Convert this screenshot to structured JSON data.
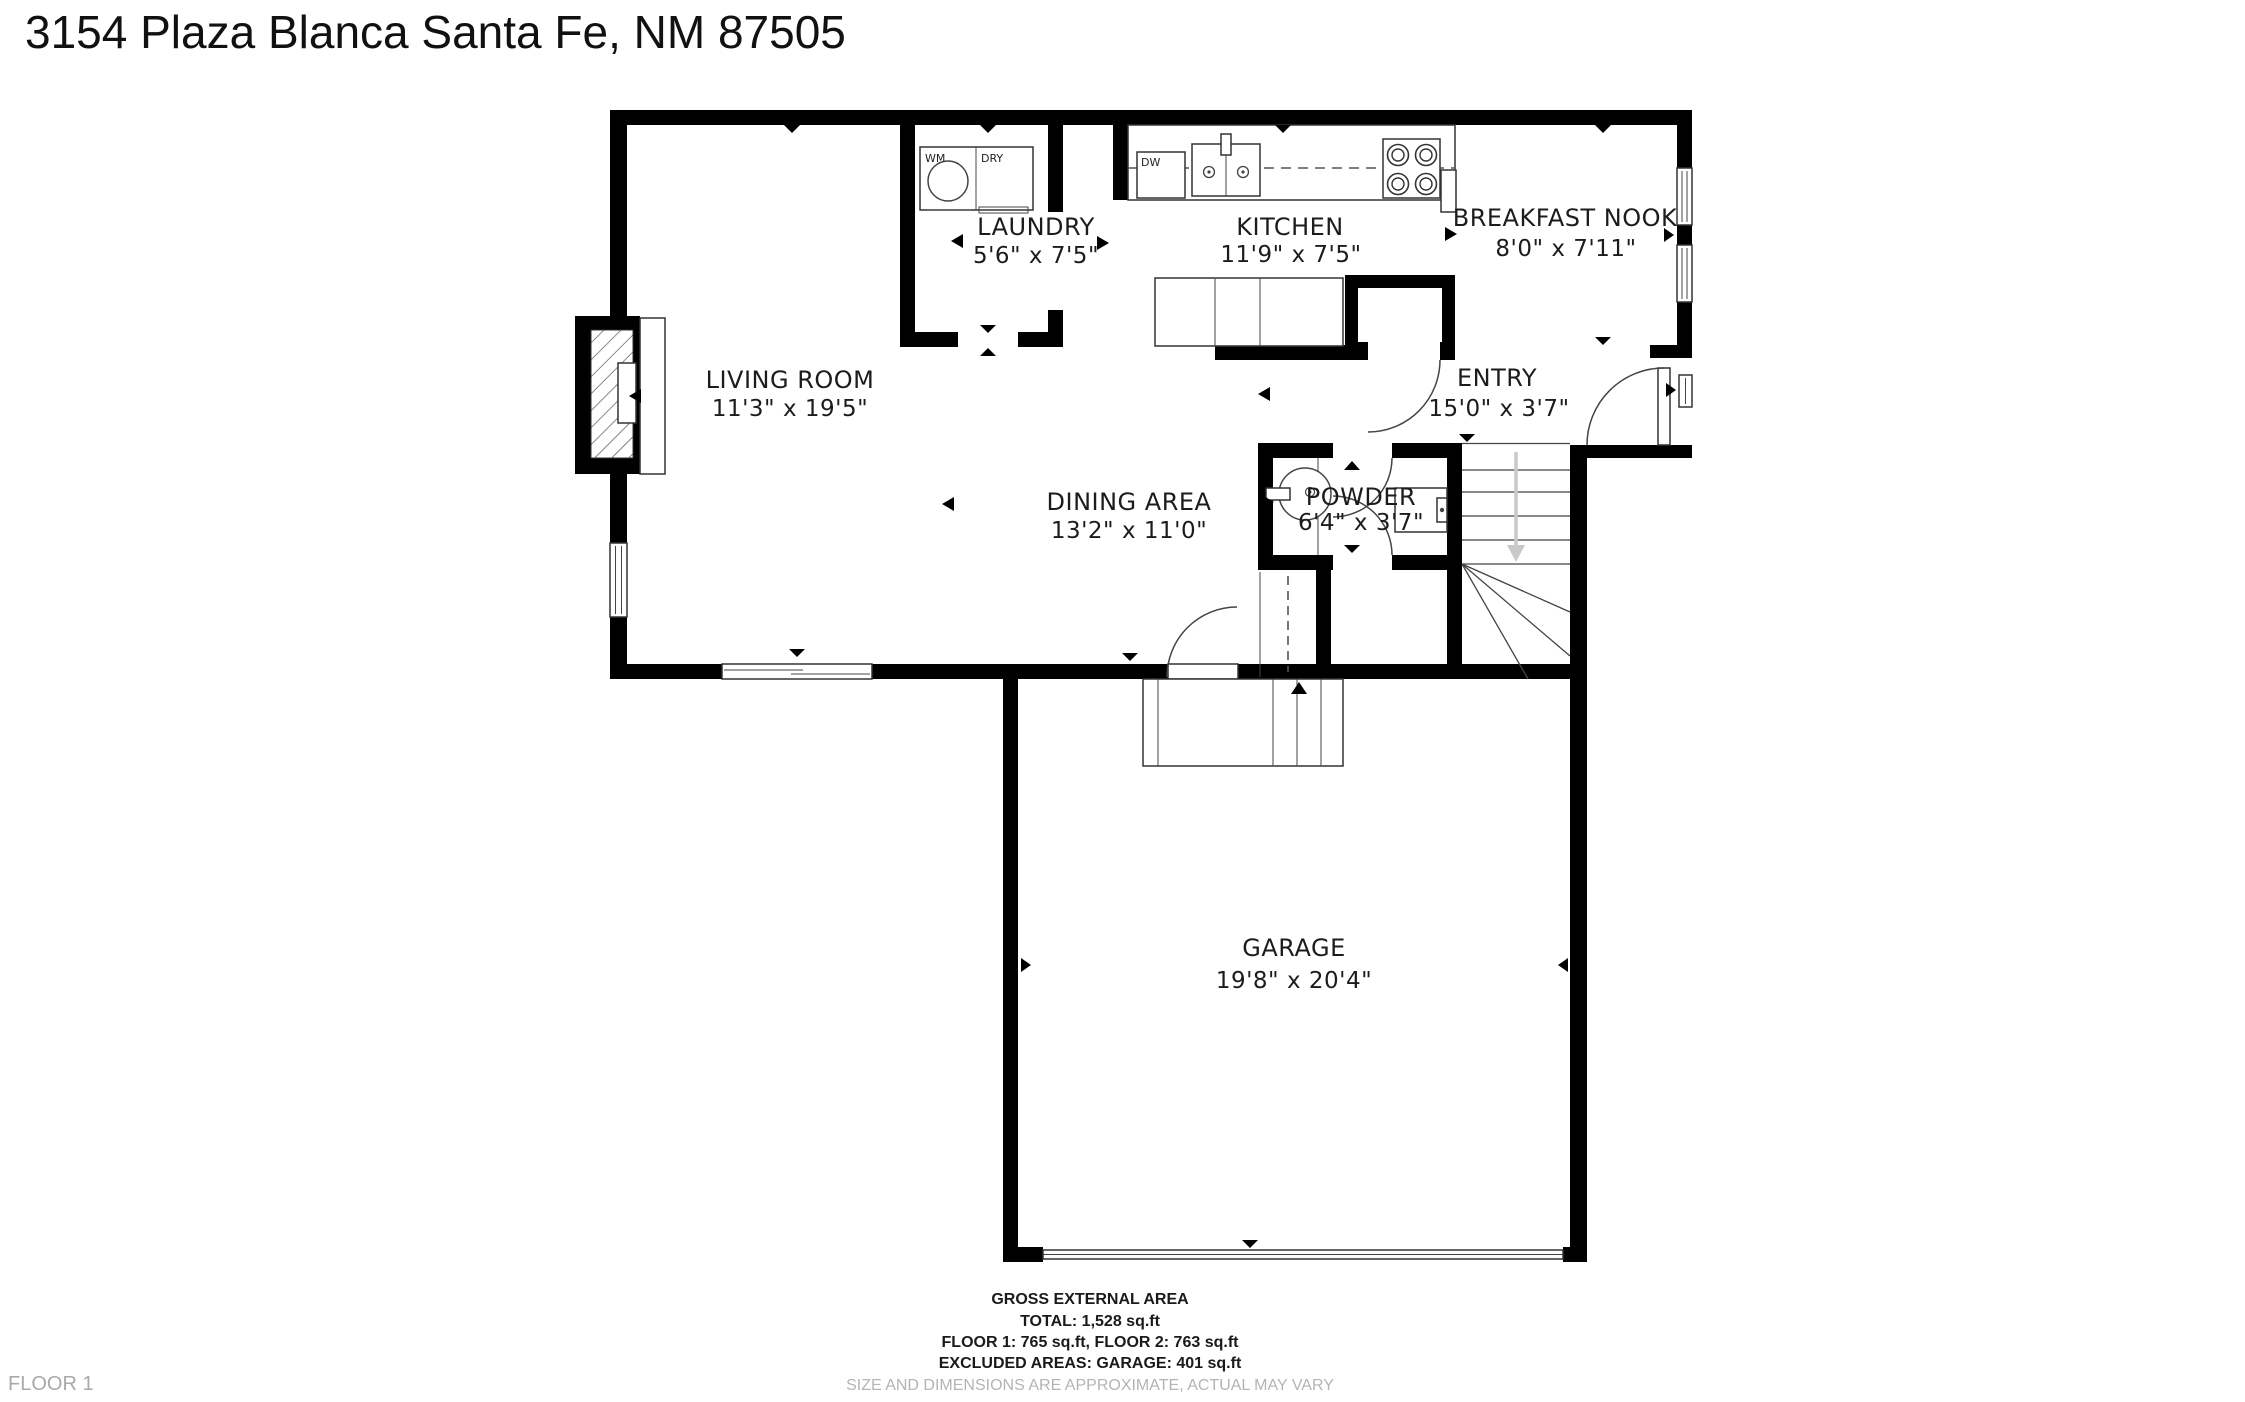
{
  "page": {
    "title": "3154 Plaza Blanca Santa Fe, NM 87505",
    "floor_label": "FLOOR 1"
  },
  "rooms": {
    "living_room": {
      "name": "LIVING ROOM",
      "dims": "11'3\" x 19'5\""
    },
    "laundry": {
      "name": "LAUNDRY",
      "dims": "5'6\" x 7'5\""
    },
    "kitchen": {
      "name": "KITCHEN",
      "dims": "11'9\" x 7'5\""
    },
    "breakfast_nook": {
      "name": "BREAKFAST NOOK",
      "dims": "8'0\" x 7'11\""
    },
    "entry": {
      "name": "ENTRY",
      "dims": "15'0\" x 3'7\""
    },
    "dining_area": {
      "name": "DINING AREA",
      "dims": "13'2\" x 11'0\""
    },
    "powder": {
      "name": "POWDER",
      "dims": "6'4\" x 3'7\""
    },
    "garage": {
      "name": "GARAGE",
      "dims": "19'8\" x 20'4\""
    }
  },
  "appliances": {
    "washer": "WM",
    "dryer": "DRY",
    "dishwasher": "DW"
  },
  "area_summary": {
    "heading": "GROSS EXTERNAL AREA",
    "total": "TOTAL: 1,528 sq.ft",
    "floors": "FLOOR 1: 765 sq.ft, FLOOR 2: 763 sq.ft",
    "excluded": "EXCLUDED AREAS: GARAGE: 401 sq.ft",
    "disclaimer": "SIZE AND DIMENSIONS ARE APPROXIMATE, ACTUAL MAY VARY"
  },
  "colors": {
    "wall": "#000000",
    "text": "#1c1c1c",
    "muted": "#b4b4b4",
    "stair_arrow": "#c9c9c9"
  }
}
